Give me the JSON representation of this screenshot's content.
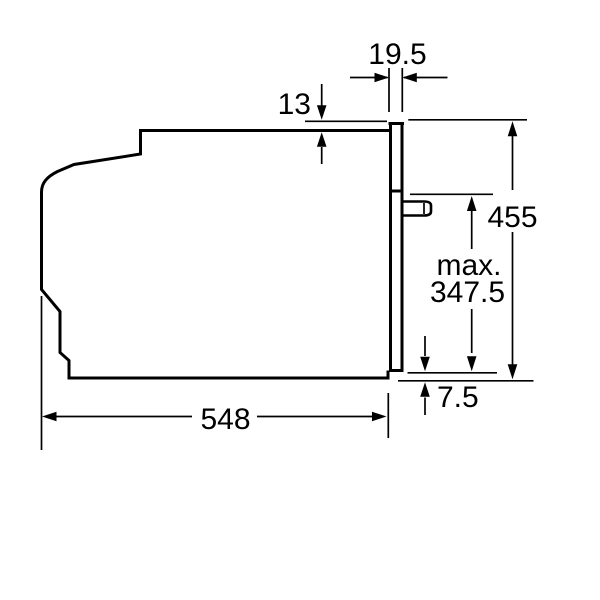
{
  "diagram": {
    "description": "Technical side-view installation drawing of a built-in oven with dimension callouts",
    "background_color": "#ffffff",
    "line_color": "#000000",
    "dimensions": {
      "top_gap": "19.5",
      "frame_overlap": "13",
      "height": "455",
      "door_projection_prefix": "max.",
      "door_projection_value": "347.5",
      "bottom_overlap": "7.5",
      "depth": "548"
    }
  }
}
